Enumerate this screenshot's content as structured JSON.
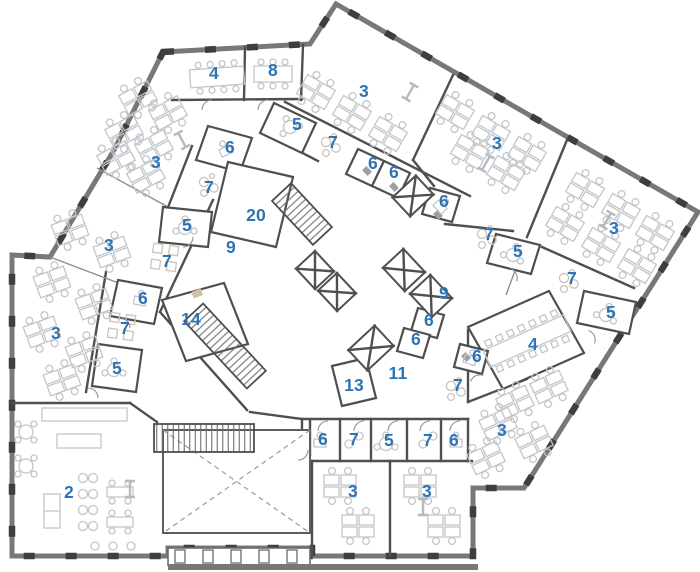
{
  "document": {
    "type": "office-floor-plan",
    "canvas": {
      "width": 700,
      "height": 572
    }
  },
  "colors": {
    "background": "#ffffff",
    "label": "#2e74b5",
    "wall": "#4f4f4f",
    "wall_exterior": "#787878",
    "window_frame": "#3e3e3e",
    "furniture": "#c2c6ca",
    "accent_tan": "#cfc0a8",
    "closet_gray": "#9aa0a6"
  },
  "plan": {
    "room_labels": [
      {
        "text": "4",
        "x": 214,
        "y": 73
      },
      {
        "text": "8",
        "x": 273,
        "y": 70
      },
      {
        "text": "3",
        "x": 364,
        "y": 91
      },
      {
        "text": "5",
        "x": 297,
        "y": 124
      },
      {
        "text": "7",
        "x": 333,
        "y": 142
      },
      {
        "text": "3",
        "x": 497,
        "y": 143
      },
      {
        "text": "6",
        "x": 230,
        "y": 147
      },
      {
        "text": "3",
        "x": 156,
        "y": 162
      },
      {
        "text": "6",
        "x": 373,
        "y": 163
      },
      {
        "text": "6",
        "x": 394,
        "y": 172
      },
      {
        "text": "7",
        "x": 209,
        "y": 187
      },
      {
        "text": "6",
        "x": 444,
        "y": 201
      },
      {
        "text": "20",
        "x": 256,
        "y": 215
      },
      {
        "text": "5",
        "x": 187,
        "y": 225
      },
      {
        "text": "3",
        "x": 614,
        "y": 228
      },
      {
        "text": "7",
        "x": 489,
        "y": 234
      },
      {
        "text": "3",
        "x": 109,
        "y": 245
      },
      {
        "text": "9",
        "x": 231,
        "y": 247
      },
      {
        "text": "5",
        "x": 518,
        "y": 251
      },
      {
        "text": "7",
        "x": 167,
        "y": 261
      },
      {
        "text": "7",
        "x": 572,
        "y": 278
      },
      {
        "text": "9",
        "x": 444,
        "y": 293
      },
      {
        "text": "6",
        "x": 143,
        "y": 298
      },
      {
        "text": "5",
        "x": 611,
        "y": 312
      },
      {
        "text": "14",
        "x": 191,
        "y": 319
      },
      {
        "text": "6",
        "x": 429,
        "y": 320
      },
      {
        "text": "7",
        "x": 125,
        "y": 328
      },
      {
        "text": "3",
        "x": 56,
        "y": 333
      },
      {
        "text": "6",
        "x": 416,
        "y": 339
      },
      {
        "text": "4",
        "x": 533,
        "y": 344
      },
      {
        "text": "6",
        "x": 477,
        "y": 356
      },
      {
        "text": "5",
        "x": 117,
        "y": 368
      },
      {
        "text": "11",
        "x": 398,
        "y": 373
      },
      {
        "text": "13",
        "x": 354,
        "y": 385
      },
      {
        "text": "7",
        "x": 458,
        "y": 385
      },
      {
        "text": "3",
        "x": 502,
        "y": 430
      },
      {
        "text": "6",
        "x": 323,
        "y": 439
      },
      {
        "text": "7",
        "x": 354,
        "y": 439
      },
      {
        "text": "5",
        "x": 389,
        "y": 440
      },
      {
        "text": "7",
        "x": 428,
        "y": 440
      },
      {
        "text": "6",
        "x": 454,
        "y": 440
      },
      {
        "text": "2",
        "x": 69,
        "y": 492
      },
      {
        "text": "3",
        "x": 353,
        "y": 491
      },
      {
        "text": "3",
        "x": 427,
        "y": 491
      }
    ]
  }
}
